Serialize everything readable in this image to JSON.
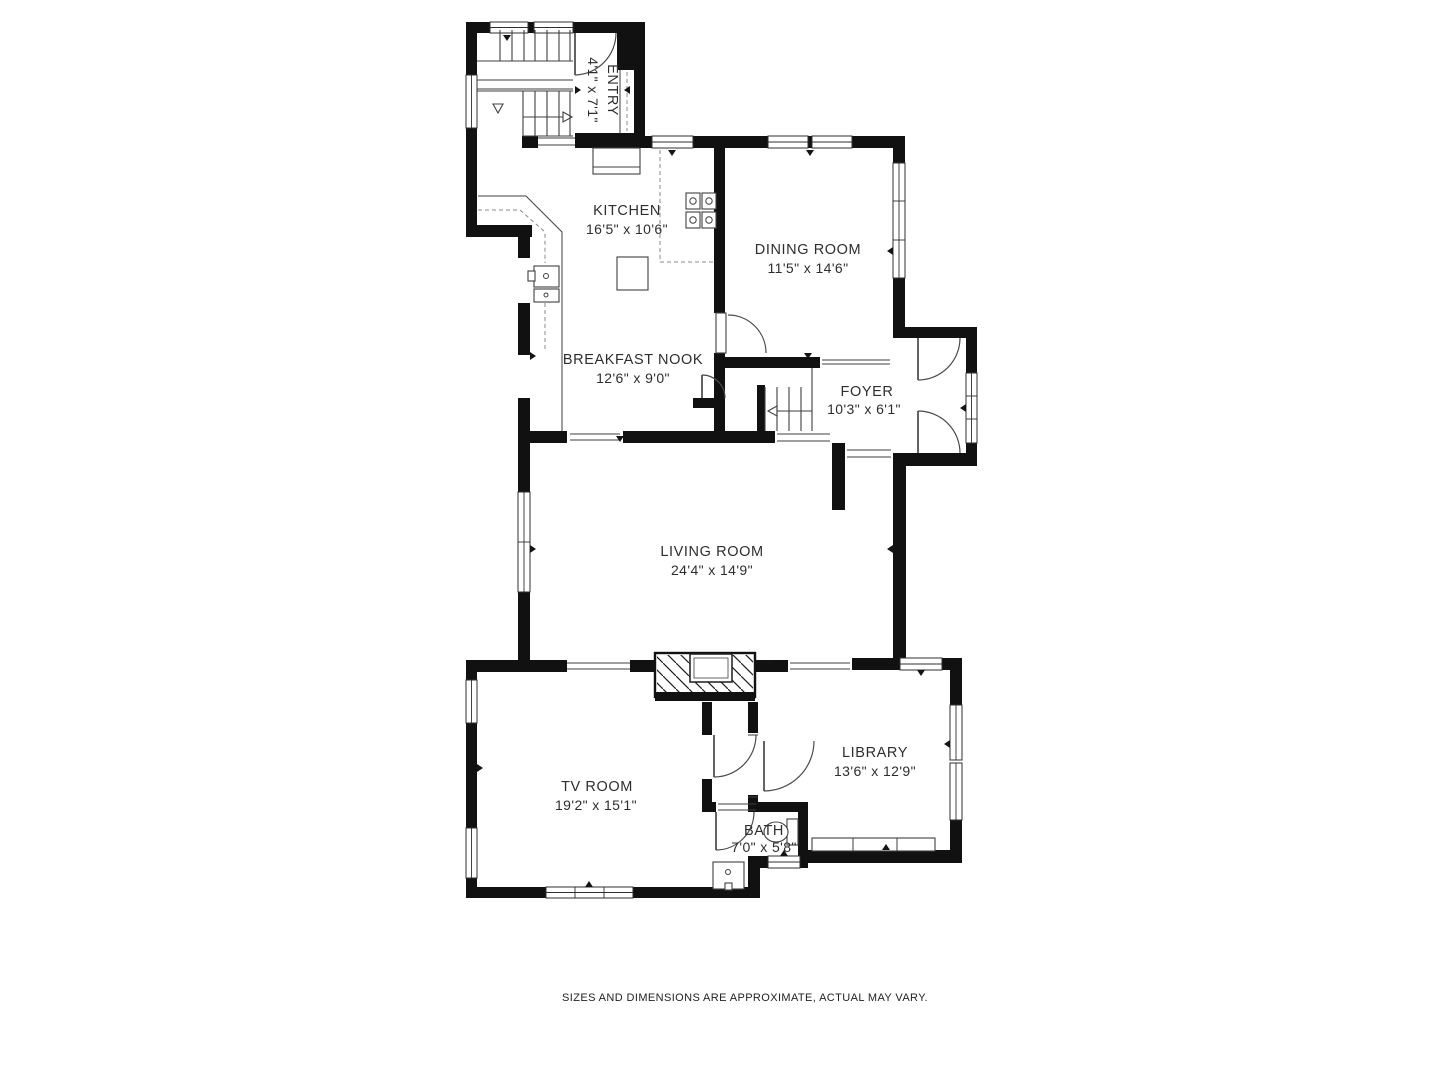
{
  "rooms": [
    {
      "id": "entry",
      "name": "ENTRY",
      "dims": "4'1\" x 7'1\""
    },
    {
      "id": "kitchen",
      "name": "KITCHEN",
      "dims": "16'5\" x 10'6\""
    },
    {
      "id": "dining",
      "name": "DINING ROOM",
      "dims": "11'5\" x 14'6\""
    },
    {
      "id": "nook",
      "name": "BREAKFAST NOOK",
      "dims": "12'6\" x 9'0\""
    },
    {
      "id": "foyer",
      "name": "FOYER",
      "dims": "10'3\" x 6'1\""
    },
    {
      "id": "living",
      "name": "LIVING ROOM",
      "dims": "24'4\" x 14'9\""
    },
    {
      "id": "tv",
      "name": "TV ROOM",
      "dims": "19'2\" x 15'1\""
    },
    {
      "id": "library",
      "name": "LIBRARY",
      "dims": "13'6\" x 12'9\""
    },
    {
      "id": "bath",
      "name": "BATH",
      "dims": "7'0\" x 5'8\""
    }
  ],
  "disclaimer": "SIZES AND DIMENSIONS ARE APPROXIMATE, ACTUAL MAY VARY.",
  "colors": {
    "wall": "#111111",
    "line": "#3f3f3f",
    "text": "#2e2e2e"
  }
}
